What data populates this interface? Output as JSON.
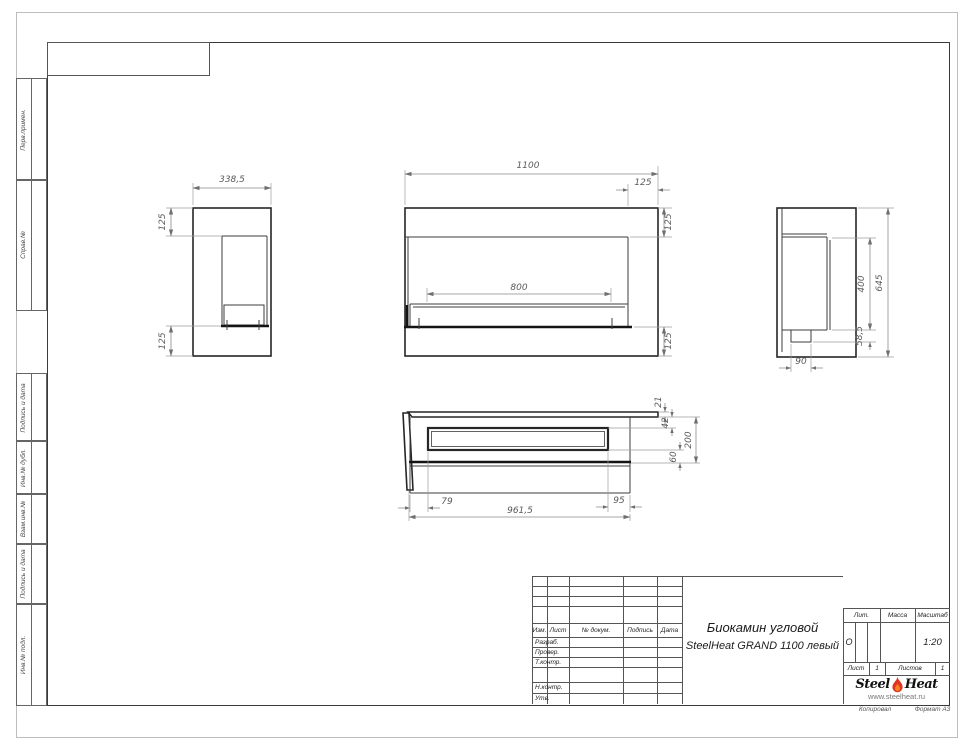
{
  "page": {
    "footer_copy": "Копировал",
    "footer_format": "Формат А3"
  },
  "margin_labels": [
    "Перв.примен.",
    "Справ.№",
    "Подпись и дата",
    "Инв.№ дубл.",
    "Взам.инв.№",
    "Подпись и дата",
    "Инв.№ подл."
  ],
  "dims": {
    "left_width": "338,5",
    "left_top": "125",
    "left_bottom": "125",
    "front_width": "1100",
    "front_right": "125",
    "front_top": "125",
    "front_bottom": "125",
    "front_burner": "800",
    "side_opening": "400",
    "side_height": "645",
    "side_bottom": "58,5",
    "side_foot": "90",
    "top_glass": "21",
    "top_inset": "42",
    "top_slot": "60",
    "top_depth": "200",
    "top_left": "79",
    "top_front": "961,5",
    "top_right": "95"
  },
  "title_block": {
    "cols": [
      "Изм.",
      "Лист",
      "№ докум.",
      "Подпись",
      "Дата"
    ],
    "rows": [
      "Разраб.",
      "Провер.",
      "Т.контр.",
      "Н.контр.",
      "Утв."
    ],
    "title_line1": "Биокамин угловой",
    "title_line2": "SteelHeat GRAND 1100 левый",
    "lit_label": "Лит.",
    "lit_value": "О",
    "mass_label": "Масса",
    "scale_label": "Масштаб",
    "scale_value": "1:20",
    "sheet_label": "Лист",
    "sheet_value": "1",
    "sheets_label": "Листов",
    "sheets_value": "1",
    "logo": {
      "steel": "Steel",
      "heat": "Heat",
      "url": "www.steelheat.ru",
      "flame_red": "#e03524",
      "flame_orange": "#f58220"
    }
  }
}
